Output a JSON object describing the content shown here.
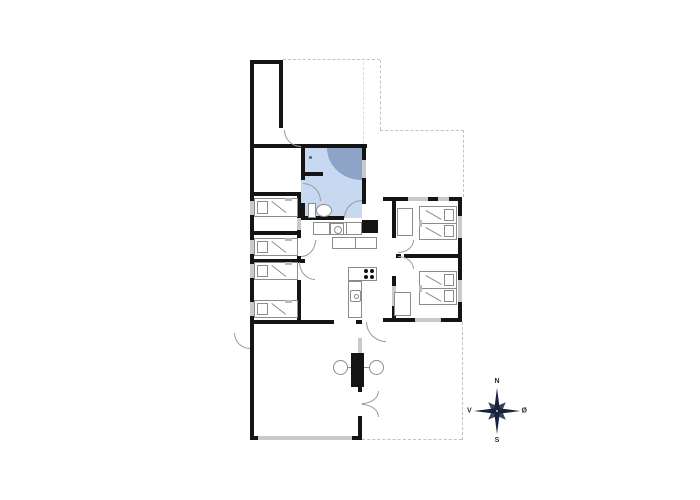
{
  "title": "holiday-home-floor-plan",
  "compass": {
    "north": "N",
    "south": "S",
    "west": "V",
    "east": "Ø"
  },
  "colors": {
    "wall": "#141414",
    "window": "#c9c9c9",
    "bathroom_fill": "#c6d9f0",
    "shower_fill": "#8da4c8",
    "dashed_line": "#c2c2c2",
    "furniture_stroke": "#8c8c8c",
    "compass": "#17233d",
    "background": "#ffffff"
  }
}
